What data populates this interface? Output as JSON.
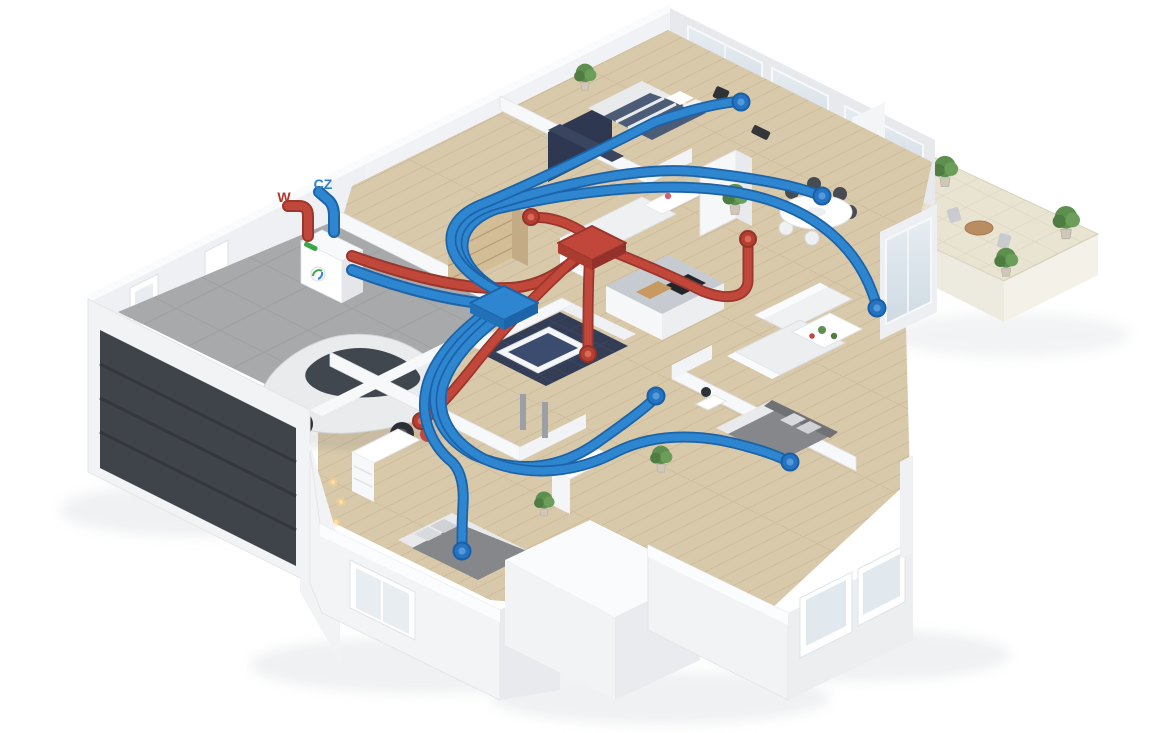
{
  "scene": {
    "type": "isometric-house-ventilation-cutaway",
    "labels": {
      "exhaust_outlet": "W",
      "fresh_air_intake": "CZ"
    },
    "unit": {
      "name": "heat-recovery-ventilation-unit",
      "logo": "green-brand-logo"
    },
    "colors": {
      "supply_duct": "#2e86d0",
      "supply_duct_outline": "#1c63a7",
      "extract_duct": "#c0473a",
      "extract_duct_outline": "#9a372d",
      "exhaust_label_color": "#b23528",
      "intake_label_color": "#2e82cb",
      "walls": "#f2f3f5",
      "wood_floor": "#d9c9ab",
      "garage_floor": "#a8a9ab",
      "garage_door": "#3f444a",
      "terrace_tile": "#e9e4d2",
      "bathroom_tile": "#333d56",
      "plant": "#5d8f4e"
    },
    "duct_system": {
      "manifolds": 2,
      "supply_terminals": 6,
      "extract_terminals": 4
    }
  }
}
